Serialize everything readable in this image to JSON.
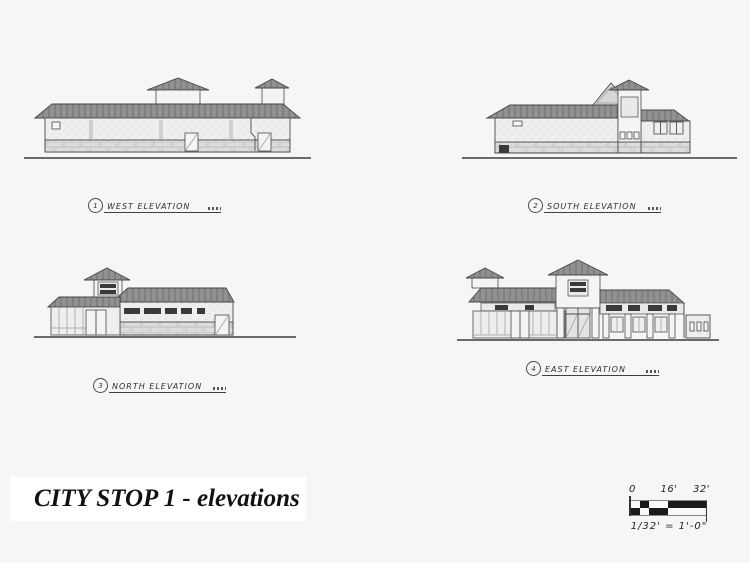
{
  "page": {
    "background_color": "#f6f6f6"
  },
  "sheet_title": {
    "text": "CITY STOP 1 - elevations"
  },
  "elevations": [
    {
      "number": "1",
      "label": "WEST ELEVATION"
    },
    {
      "number": "2",
      "label": "SOUTH ELEVATION"
    },
    {
      "number": "3",
      "label": "NORTH ELEVATION"
    },
    {
      "number": "4",
      "label": "EAST ELEVATION"
    }
  ],
  "scale_bar": {
    "ticks": [
      "0",
      "16'",
      "32'"
    ],
    "note": "1/32' = 1'-0\""
  },
  "colors": {
    "ink": "#3a3a3a",
    "roof_gray": "#8f8f8f",
    "wall_gray": "#efefef",
    "stone_gray": "#dcdcdc",
    "sign_dark": "#3a3a3a",
    "title_ink": "#111111"
  }
}
